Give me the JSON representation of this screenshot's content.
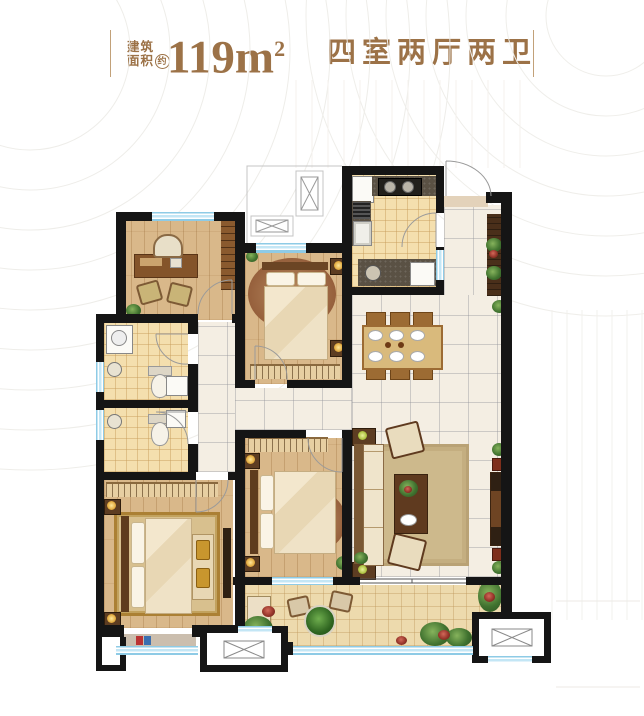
{
  "header": {
    "area_label_line1": "建筑",
    "area_label_line2": "面积",
    "area_approx_badge": "约",
    "area_value": "119m",
    "area_superscript": "2",
    "layout_label": "四室两厅两卫",
    "accent_color": "#9c7247"
  },
  "plan": {
    "colors": {
      "wall": "#151515",
      "window_glass": "#8ecbe6",
      "wood_floor": "#d9b88a",
      "marble_tile": "#f4eee3",
      "bath_tile": "#f4dfae",
      "balcony_tile": "#eddaad",
      "counter_granite": "#5a5144",
      "dark_wood": "#4a2f1a",
      "rug_gold_frame": "#ab8034",
      "plant_green": "#40722f",
      "flower_red": "#96352a"
    },
    "icons": [
      "door-swing-arc",
      "equipment-platform-x-box",
      "stair-shaft-x-box",
      "window-triple-line",
      "sliding-door-line"
    ]
  }
}
